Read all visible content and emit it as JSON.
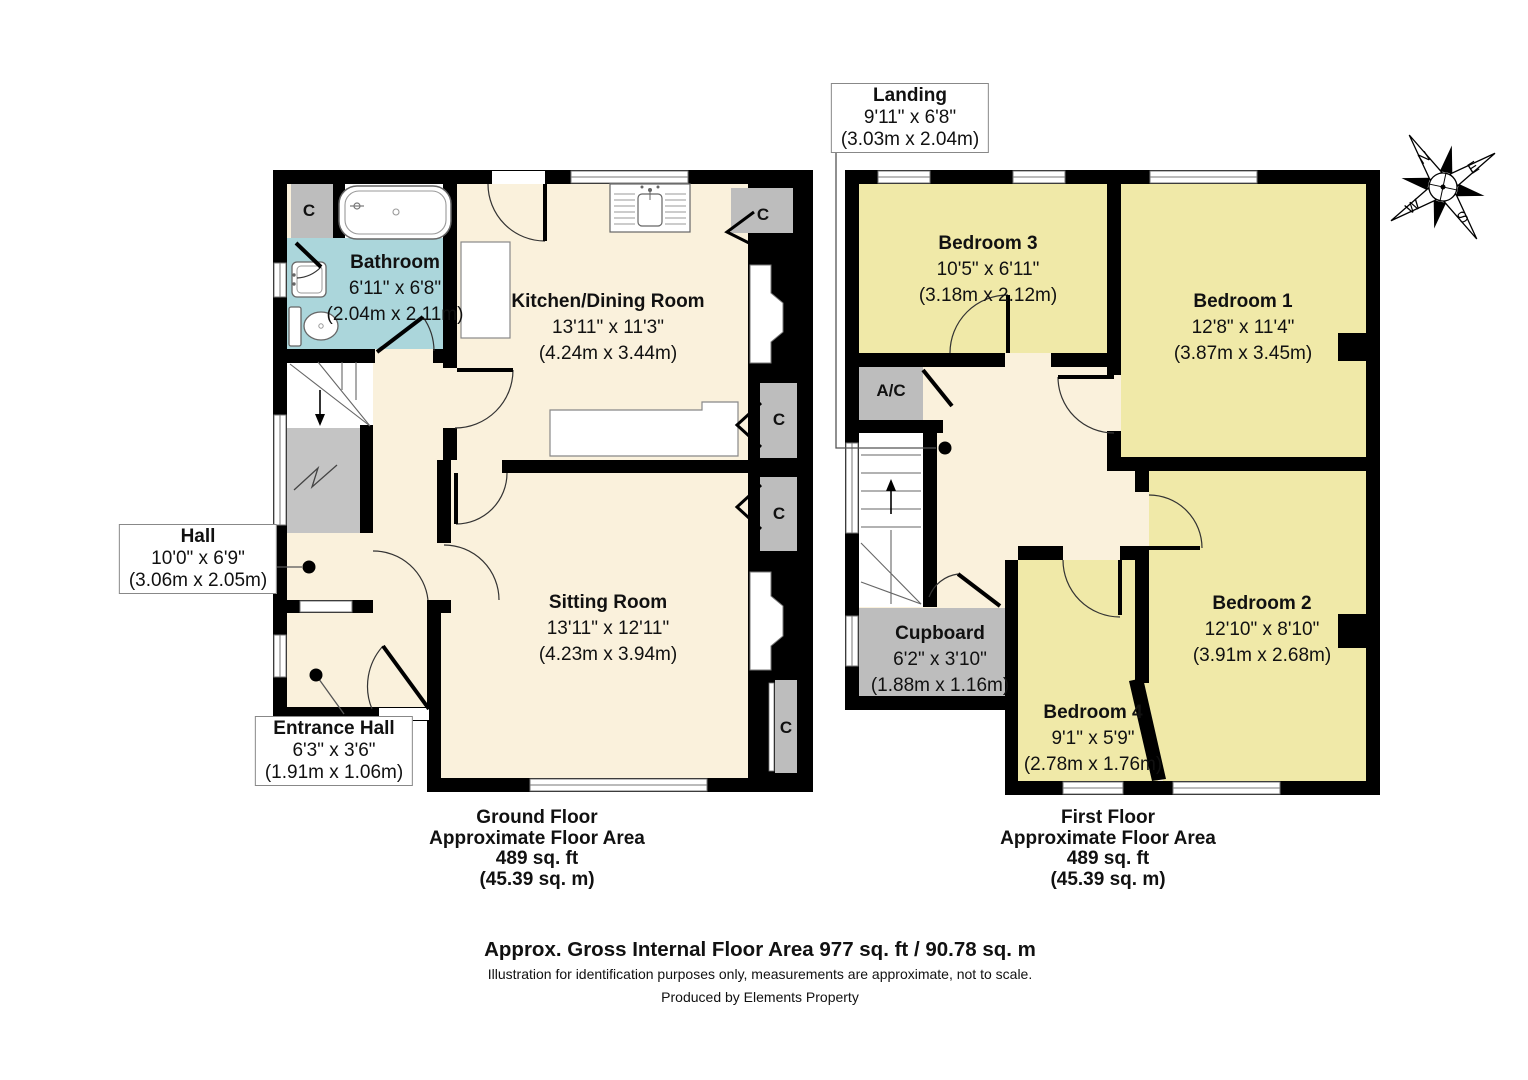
{
  "ground_floor": {
    "title": [
      "Ground Floor",
      "Approximate Floor Area",
      "489 sq. ft",
      "(45.39 sq. m)"
    ],
    "rooms": {
      "bathroom": {
        "name": "Bathroom",
        "size_imperial": "6'11\" x 6'8\"",
        "size_metric": "(2.04m x 2.11m)"
      },
      "kitchen_dining": {
        "name": "Kitchen/Dining Room",
        "size_imperial": "13'11\" x 11'3\"",
        "size_metric": "(4.24m x 3.44m)"
      },
      "sitting_room": {
        "name": "Sitting Room",
        "size_imperial": "13'11\" x 12'11\"",
        "size_metric": "(4.23m x 3.94m)"
      },
      "hall": {
        "name": "Hall",
        "size_imperial": "10'0\" x 6'9\"",
        "size_metric": "(3.06m x 2.05m)"
      },
      "entrance_hall": {
        "name": "Entrance Hall",
        "size_imperial": "6'3\" x 3'6\"",
        "size_metric": "(1.91m x 1.06m)"
      }
    }
  },
  "first_floor": {
    "title": [
      "First Floor",
      "Approximate Floor Area",
      "489 sq. ft",
      "(45.39 sq. m)"
    ],
    "rooms": {
      "landing": {
        "name": "Landing",
        "size_imperial": "9'11\" x 6'8\"",
        "size_metric": "(3.03m x 2.04m)"
      },
      "bedroom1": {
        "name": "Bedroom 1",
        "size_imperial": "12'8\" x 11'4\"",
        "size_metric": "(3.87m x 3.45m)"
      },
      "bedroom2": {
        "name": "Bedroom 2",
        "size_imperial": "12'10\" x 8'10\"",
        "size_metric": "(3.91m x 2.68m)"
      },
      "bedroom3": {
        "name": "Bedroom 3",
        "size_imperial": "10'5\" x 6'11\"",
        "size_metric": "(3.18m x 2.12m)"
      },
      "bedroom4": {
        "name": "Bedroom 4",
        "size_imperial": "9'1\" x 5'9\"",
        "size_metric": "(2.78m x 1.76m)"
      },
      "cupboard": {
        "name": "Cupboard",
        "size_imperial": "6'2\" x 3'10\"",
        "size_metric": "(1.88m x 1.16m)"
      }
    }
  },
  "labels": {
    "closet": "C",
    "air_conditioning": "A/C"
  },
  "compass": {
    "north": "N",
    "east": "E",
    "south": "S",
    "west": "W"
  },
  "footer": {
    "total_area": "Approx. Gross Internal Floor Area 977 sq. ft / 90.78 sq. m",
    "disclaimer": "Illustration for identification purposes only, measurements are approximate, not to scale.",
    "credit": "Produced by Elements Property"
  },
  "colors": {
    "room_cream": "#FAF1DC",
    "bedroom_yellow": "#F0E9A8",
    "bathroom_blue": "#ABD6DB",
    "closet_gray": "#BDBDBD",
    "wall": "#000000"
  }
}
